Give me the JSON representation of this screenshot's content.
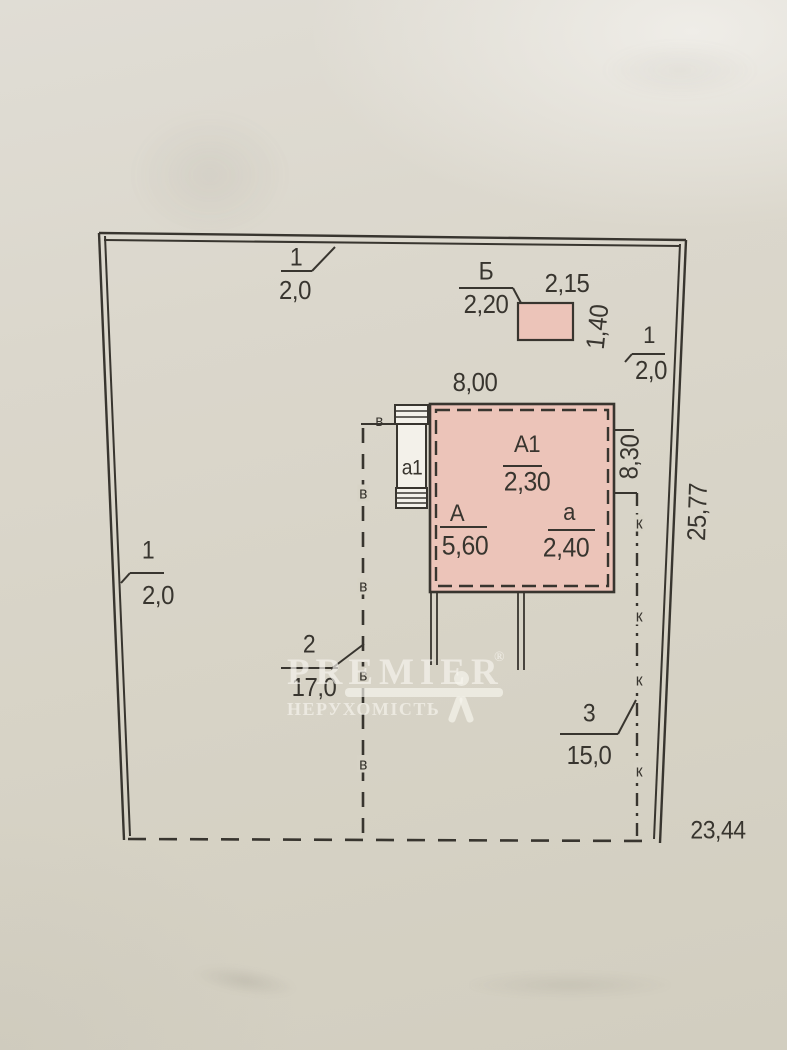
{
  "colors": {
    "ink": "#38352f",
    "paper_mid": "#d7d3c6",
    "building_fill": "#ecc4b9",
    "watermark": "#f6f4ee"
  },
  "watermark": {
    "brand": "PREMIER",
    "reg": "®",
    "subtitle": "НЕРУХОМІСТЬ"
  },
  "plan": {
    "sections": {
      "top": {
        "num": "1",
        "len": "2,0"
      },
      "left": {
        "num": "1",
        "len": "2,0"
      },
      "right_upper": {
        "num": "1",
        "len": "2,0"
      },
      "fence2": {
        "num": "2",
        "len": "17,0"
      },
      "fence3": {
        "num": "3",
        "len": "15,0"
      }
    },
    "dims": {
      "right_side": "25,77",
      "bottom_side": "23,44",
      "bldg_width": "8,00",
      "bldg_depth": "8,30"
    },
    "bldgB": {
      "letter": "Б",
      "width": "2,20",
      "top": "2,15",
      "height": "1,40"
    },
    "bldgMain": {
      "upper": {
        "letter": "А1",
        "val": "2,30"
      },
      "main": {
        "letter": "А",
        "val": "5,60"
      },
      "lower": {
        "letter": "а",
        "val": "2,40"
      },
      "annex": "а1"
    },
    "marks": {
      "v": "в",
      "k": "к"
    }
  }
}
